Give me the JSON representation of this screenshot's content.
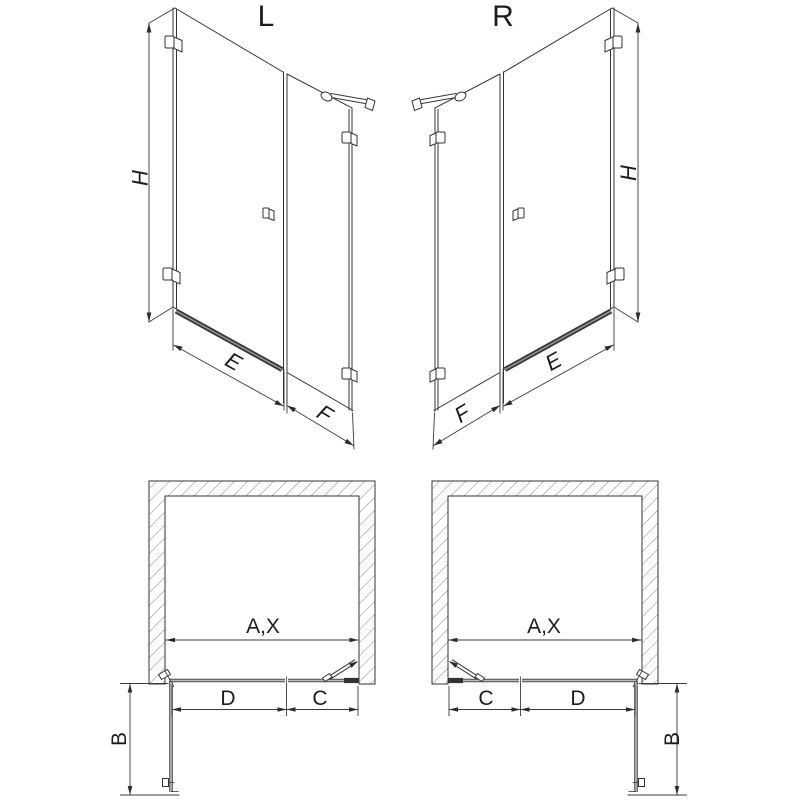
{
  "views": {
    "elevation_left": {
      "title": "L",
      "height": "H",
      "door_width": "E",
      "panel_width": "F"
    },
    "elevation_right": {
      "title": "R",
      "height": "H",
      "door_width": "E",
      "panel_width": "F"
    },
    "plan_left": {
      "opening_width": "A,X",
      "door_width": "D",
      "panel_width": "C",
      "door_depth": "B"
    },
    "plan_right": {
      "opening_width": "A,X",
      "door_width": "D",
      "panel_width": "C",
      "door_depth": "B"
    }
  },
  "colors": {
    "background": "#ffffff",
    "line": "#333333",
    "dimension_line": "#3a3a3a",
    "hatch": "#8a8a8a",
    "glass_edge": "#4a4a4a",
    "glass_core": "#bdbdbd",
    "threshold_bar": "#3a3a3a",
    "text": "#1c1c1c"
  }
}
